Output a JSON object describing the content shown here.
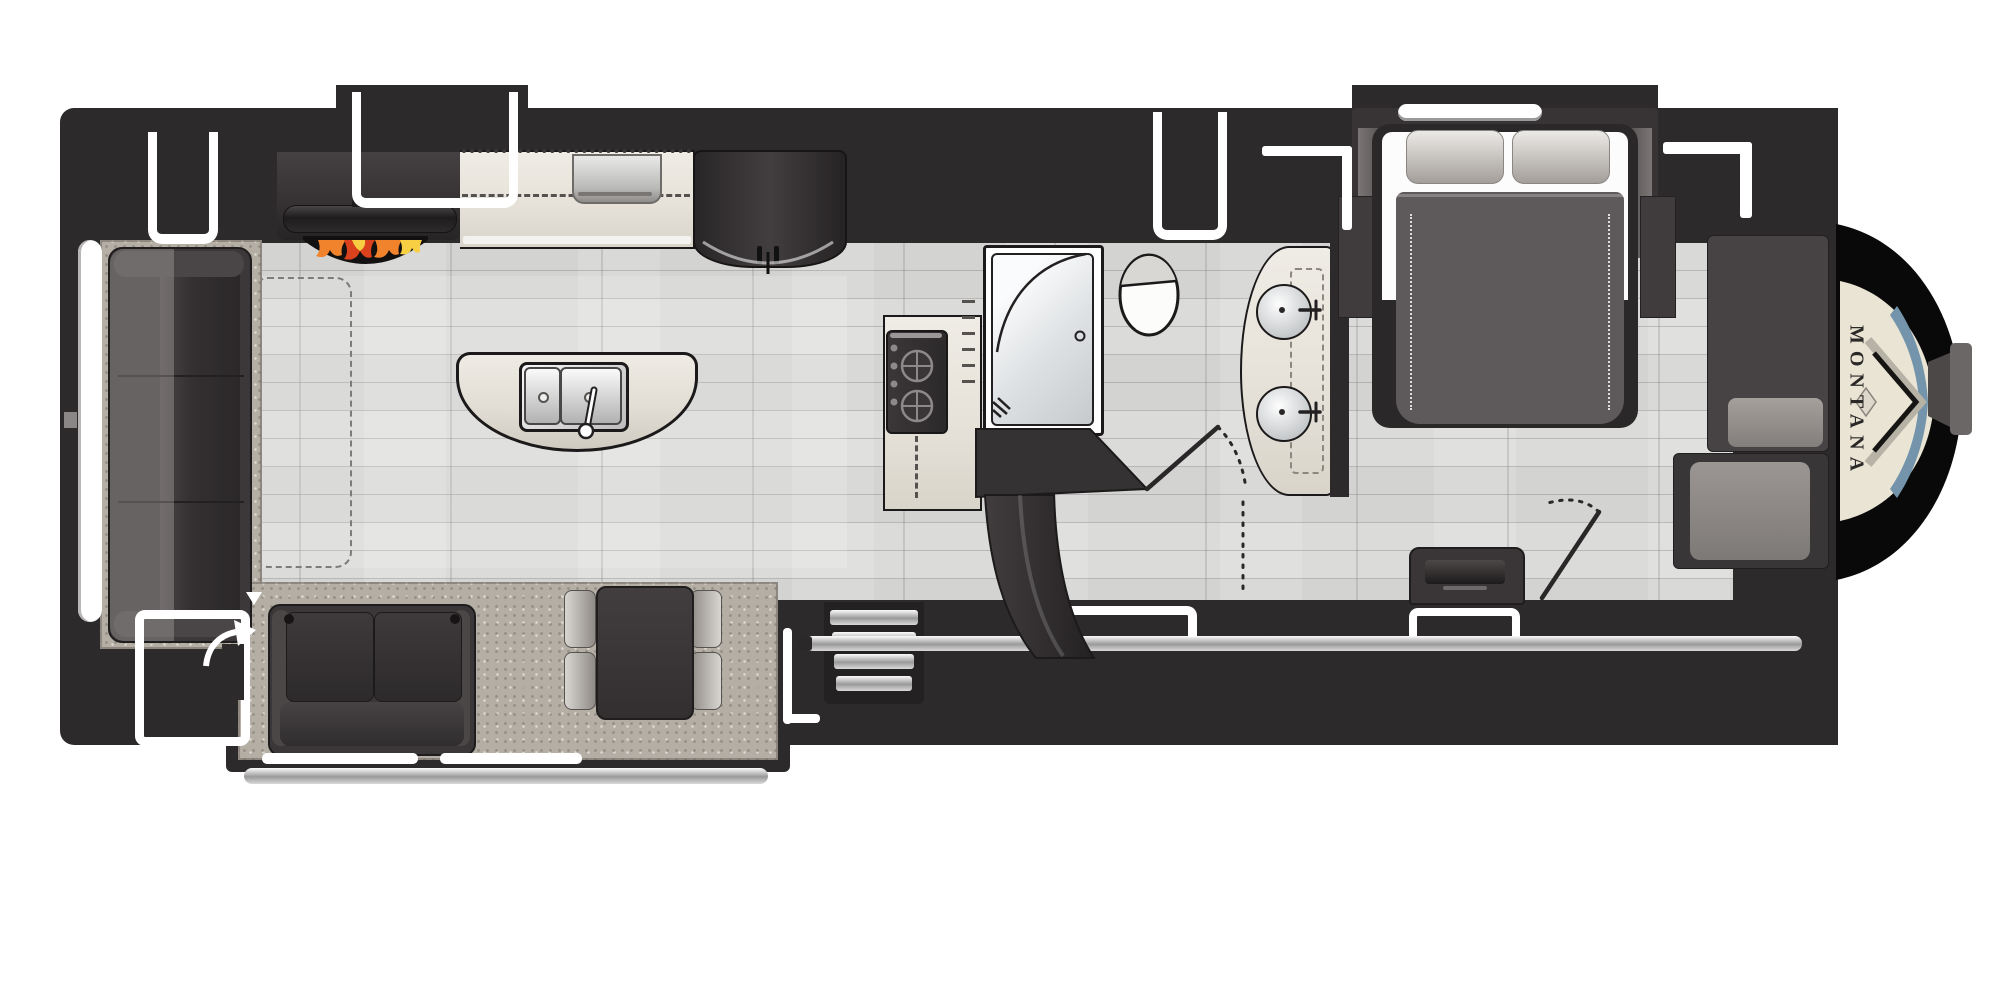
{
  "brand": {
    "logo_text": "MONTANA"
  },
  "palette": {
    "wall": "#2d2a2b",
    "wall_mid": "#3b3738",
    "furniture_dark": "#353132",
    "floor": "#dbdbd9",
    "carpet": "#b4aea5",
    "counter": "#e6e2d9",
    "island": "#e2ded5",
    "metal_light": "#f2f2f2",
    "metal_dark": "#8c8c8c",
    "cap_black": "#0a0909",
    "cap_cream": "#e9e4d4",
    "cap_blue": "#7394ab",
    "cap_text": "#2b2927",
    "flame_red": "#d9421c",
    "flame_orange": "#f0832b",
    "flame_yellow": "#f8ce42",
    "line_dark": "#1b1919",
    "white": "#ffffff"
  },
  "fixtures": [
    "rear-sofa",
    "entertainment-center",
    "fireplace",
    "tv",
    "overhead-cabinets",
    "kitchen-counter",
    "microwave",
    "refrigerator",
    "kitchen-island",
    "double-sink",
    "faucet",
    "range-cooktop",
    "shower",
    "toilet",
    "double-sink-vanity",
    "stairs",
    "landing",
    "bathroom-door",
    "bedroom-door",
    "loveseat",
    "dinette-table",
    "dinette-chairs",
    "area-rug",
    "entry-steps",
    "entry-door",
    "queen-bed",
    "pillows",
    "nightstands",
    "dresser-tv",
    "wardrobe-closet",
    "front-closet",
    "front-cap",
    "hitch-pin",
    "awning-rail",
    "windows",
    "rear-window"
  ]
}
